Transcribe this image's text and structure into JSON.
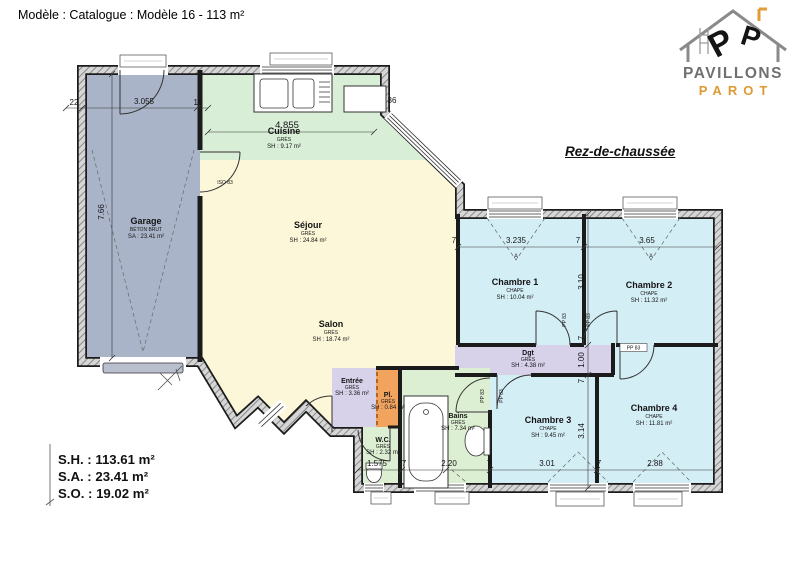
{
  "header": {
    "title": "Modèle : Catalogue : Modèle 16 - 113 m²"
  },
  "logo": {
    "brand_top": "PAVILLONS",
    "brand_bottom": "PAROT",
    "letter": "P"
  },
  "floor_label": "Rez-de-chaussée",
  "rooms": [
    {
      "name": "Garage",
      "material": "BÉTON BRUT",
      "area": "SA : 23.41 m²"
    },
    {
      "name": "Cuisine",
      "material": "GRÈS",
      "area": "SH : 9.17 m²"
    },
    {
      "name": "Séjour",
      "material": "GRÈS",
      "area": "SH : 24.84 m²"
    },
    {
      "name": "Salon",
      "material": "GRÈS",
      "area": "SH : 18.74 m²"
    },
    {
      "name": "Chambre 1",
      "material": "CHAPE",
      "area": "SH : 10.04 m²"
    },
    {
      "name": "Chambre 2",
      "material": "CHAPE",
      "area": "SH : 11.32 m²"
    },
    {
      "name": "Dgt",
      "material": "GRÈS",
      "area": "SH : 4.38 m²"
    },
    {
      "name": "Entrée",
      "material": "GRÈS",
      "area": "SH : 3.36 m²"
    },
    {
      "name": "Pl.",
      "material": "GRÈS",
      "area": "SH : 0.84 m²"
    },
    {
      "name": "Bains",
      "material": "GRÈS",
      "area": "SH : 7.34 m²"
    },
    {
      "name": "W.C.",
      "material": "GRÈS",
      "area": "SH : 2.32 m²"
    },
    {
      "name": "Chambre 3",
      "material": "CHAPE",
      "area": "SH : 9.45 m²"
    },
    {
      "name": "Chambre 4",
      "material": "CHAPE",
      "area": "SH : 11.81 m²"
    }
  ],
  "dims": {
    "garage_top": [
      "22",
      "3.055",
      "15"
    ],
    "cuisine_width": "4.855",
    "wall_36": "36",
    "garage_height": "7.66",
    "bedrooms_top": [
      "7",
      "3.235",
      "7",
      "3.65"
    ],
    "right_col": [
      "3.10",
      "7",
      "1.00",
      "7",
      "3.14"
    ],
    "bottom": [
      "1.575",
      "7",
      "2.20",
      "7",
      "3.01",
      "7",
      "2.88"
    ]
  },
  "door_labels": {
    "iso": "ISO 83",
    "pp": "PP 83",
    "window_mark": "A"
  },
  "summary": {
    "lines": [
      "S.H. : 113.61 m²",
      "S.A. : 23.41 m²",
      "S.O. : 19.02 m²"
    ]
  },
  "colors": {
    "garage": "#aab4c9",
    "kitchen": "#d8eed7",
    "living": "#fcf7d8",
    "bedroom": "#d4eef6",
    "hall": "#d7d1ea",
    "closet": "#f2a45f",
    "bath": "#ddefd3",
    "wall": "#1b1b1b",
    "brand_gray": "#6f7072",
    "brand_orange": "#dd9a33"
  }
}
